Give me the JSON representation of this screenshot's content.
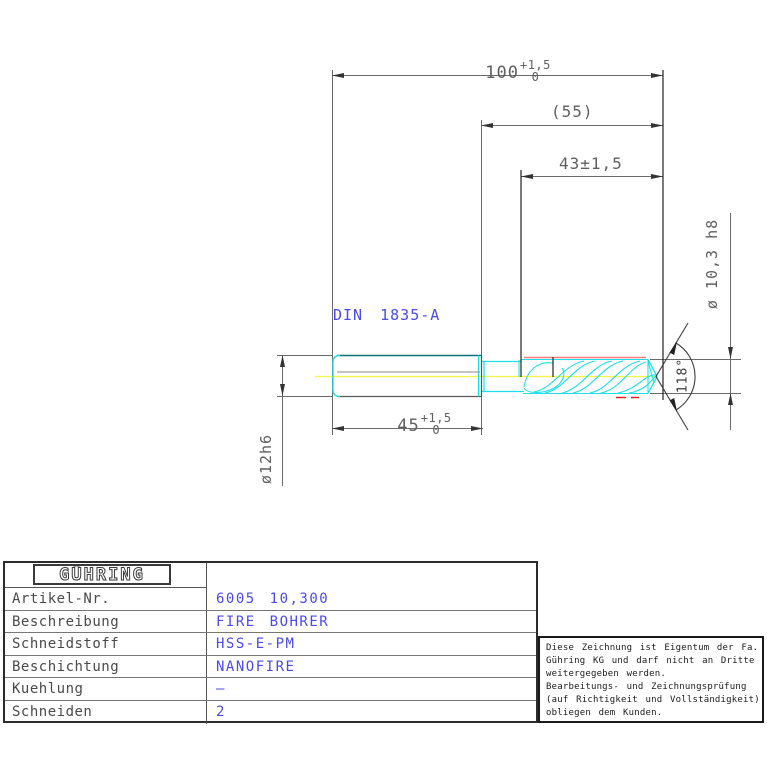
{
  "drawing": {
    "din_label": "DIN 1835-A",
    "dim_overall_length": {
      "main": "100",
      "tol_top": "+1,5",
      "tol_bottom": "0"
    },
    "dim_ref_length": "(55)",
    "dim_flute_length": "43±1,5",
    "dim_shank_length": {
      "main": "45",
      "tol_top": "+1,5",
      "tol_bottom": "0"
    },
    "dim_shank_diameter": "ø12h6",
    "dim_drill_diameter": "ø 10,3 h8",
    "dim_point_angle": "118°"
  },
  "title_block": {
    "logo": "GÜHRING",
    "rows": [
      {
        "label": "Artikel-Nr.",
        "value": "6005 10,300"
      },
      {
        "label": "Beschreibung",
        "value": "FIRE BOHRER"
      },
      {
        "label": "Schneidstoff",
        "value": "HSS-E-PM"
      },
      {
        "label": "Beschichtung",
        "value": "NANOFIRE"
      },
      {
        "label": "Kuehlung",
        "value": "–"
      },
      {
        "label": "Schneiden",
        "value": "2"
      }
    ]
  },
  "notice": {
    "lines": [
      "Diese Zeichnung ist Eigentum der Fa.",
      "Gühring KG und darf nicht an Dritte",
      "weitergegeben werden.",
      "Bearbeitungs- und Zeichnungsprüfung",
      "(auf Richtigkeit und Vollständigkeit)",
      "obliegen dem Kunden."
    ]
  },
  "colors": {
    "dimension_gray": "#5f5f5f",
    "cad_blue": "#4a4aee",
    "outline_cyan": "#1ee0ea",
    "shank_teal": "#0a7474",
    "centerline_yellow": "#f6f640",
    "margin_red": "#f87e7e",
    "dash_red": "#e02020"
  }
}
